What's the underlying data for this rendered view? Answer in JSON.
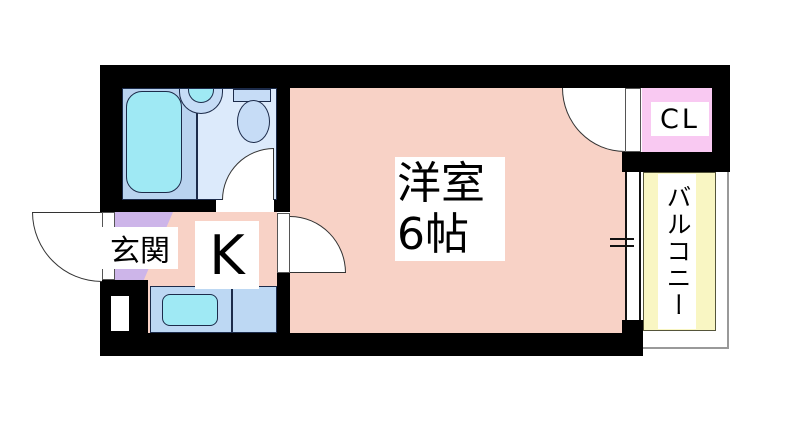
{
  "floorplan": {
    "labels": {
      "entrance": "玄関",
      "kitchen": "K",
      "main_room_line1": "洋室",
      "main_room_line2": "6帖",
      "closet": "CL",
      "balcony": "バルコニー"
    },
    "colors": {
      "wall": "#000000",
      "room": "#f8d2c6",
      "entrance": "#cdb5e9",
      "bathroom_wet": "#b9d3ef",
      "bathroom_dry": "#dceafb",
      "fixture": "#c6dcf6",
      "water": "#9fe9f4",
      "counter": "#bdd8f3",
      "closet": "#f9c9f2",
      "balcony": "#f9f6c3",
      "outline": "#1c2b4a"
    }
  }
}
